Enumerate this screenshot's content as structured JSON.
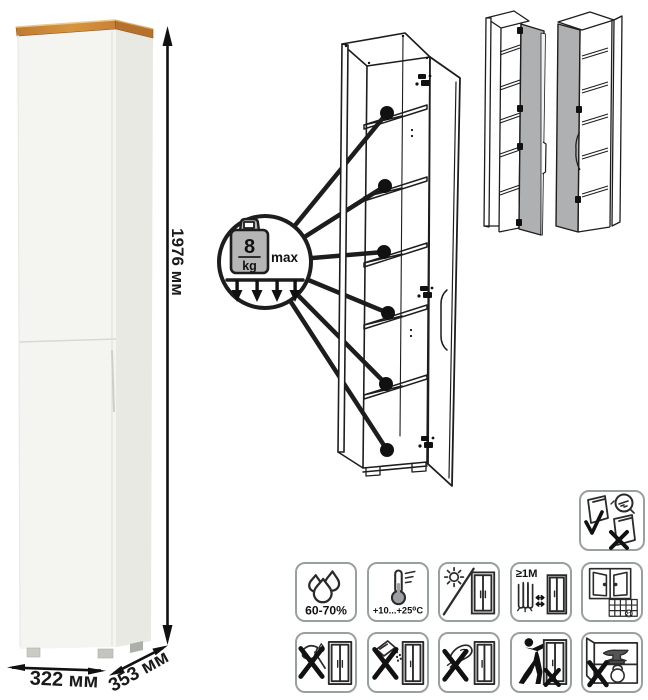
{
  "product": {
    "type_note": "tall narrow one-door cabinet infographic",
    "dims": {
      "height": "1976 мм",
      "width": "322 мм",
      "depth": "353 мм"
    },
    "shelf_load": {
      "value": "8",
      "unit": "kg",
      "qualifier": "max",
      "shelf_callouts": 6
    },
    "door_variants": 2
  },
  "care_icons": {
    "wall_anchor": {
      "name": "anchor-to-wall-warning"
    },
    "humidity": {
      "label": "60-70%"
    },
    "temperature": {
      "label": "+10...+25⁰C"
    },
    "sunlight": {
      "name": "avoid-direct-sunlight"
    },
    "heat_distance": {
      "label": "≥1М"
    },
    "ventilation": {
      "calendar_day": "21"
    },
    "no_axe": {
      "name": "no-sharp-impacts"
    },
    "no_abrasives": {
      "name": "no-abrasive-powders"
    },
    "no_wet_cloth": {
      "name": "no-harsh-scrubbing"
    },
    "no_dragging": {
      "name": "do-not-drag"
    },
    "no_overload": {
      "name": "do-not-overload"
    }
  },
  "colors": {
    "wood_top": "#c8813a",
    "cabinet_front": "#f4f4f0",
    "cabinet_side": "#e8e9e2",
    "line_art": "#1d1d1d",
    "door_gray": "#aeb0b2",
    "icon_border": "#9aa0a0"
  }
}
